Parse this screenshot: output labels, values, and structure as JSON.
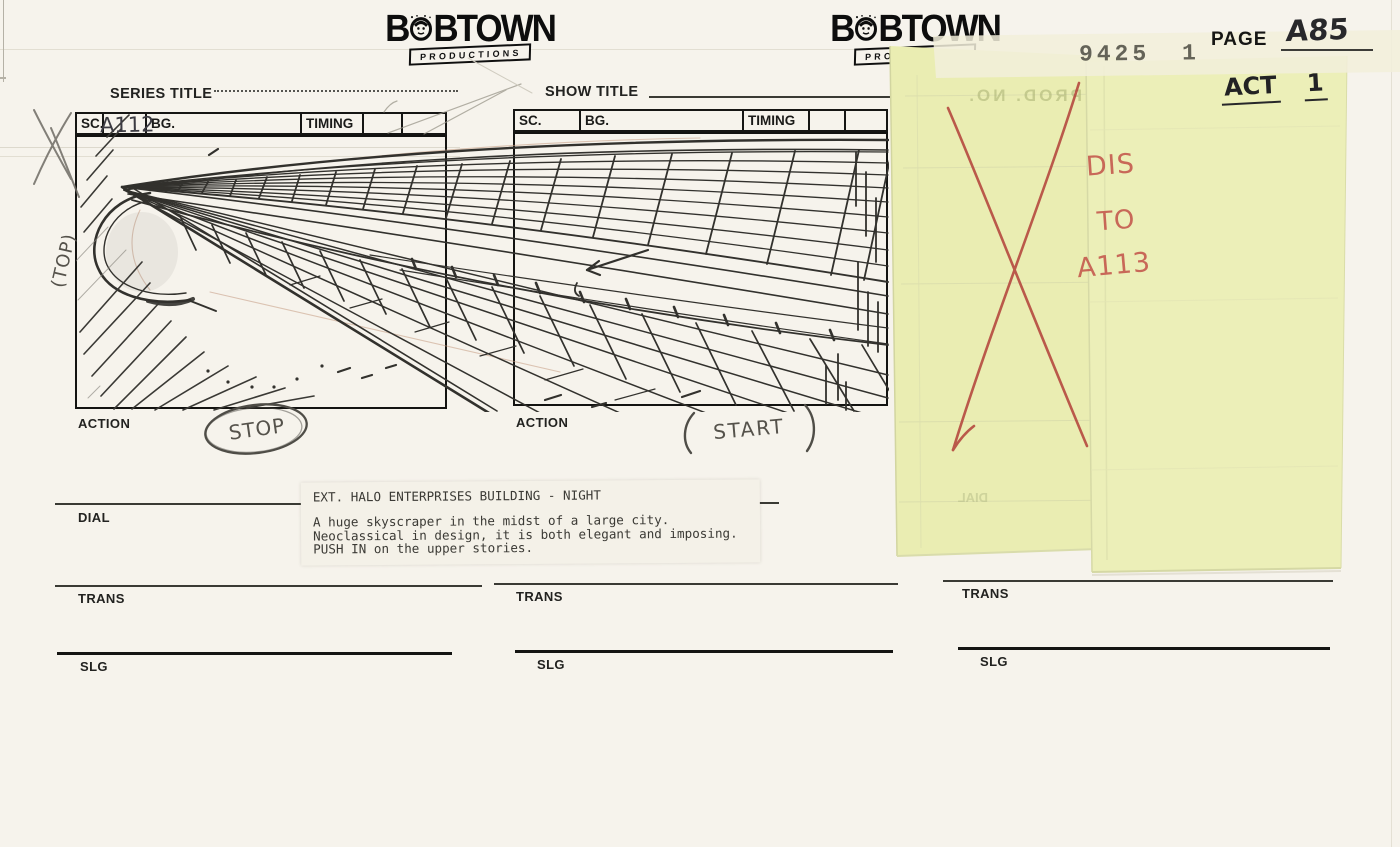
{
  "logo": {
    "word_start": "B",
    "word_end": "BTOWN",
    "banner": "PRODUCTIONS"
  },
  "header": {
    "stamp": "9425 1",
    "page_label": "PAGE",
    "page_number": "A85",
    "act_label": "ACT",
    "act_number": "1"
  },
  "form": {
    "series_title_label": "SERIES TITLE",
    "show_title_label": "SHOW TITLE",
    "sc_label": "SC.",
    "bg_label": "BG.",
    "timing_label": "TIMING",
    "action_label": "ACTION",
    "dial_label": "DIAL",
    "trans_label": "TRANS",
    "slg_label": "SLG",
    "panel1_scene_number": "A112"
  },
  "annotations": {
    "top_note": "(TOP)",
    "stop_note": "STOP",
    "start_note": "START",
    "dissolve_line1": "DIS",
    "dissolve_line2": "TO",
    "dissolve_line3": "A113"
  },
  "script_note": {
    "slugline": "EXT.  HALO ENTERPRISES BUILDING - NIGHT",
    "line1": "A huge skyscraper in the midst of a large city.",
    "line2": "Neoclassical in design, it is both elegant and imposing.",
    "line3": "PUSH IN on the upper stories."
  },
  "ghost_text": {
    "prod_no": "PROD. NO.",
    "dial": "DIAL"
  },
  "colors": {
    "paper": "#f6f3ec",
    "ink": "#141412",
    "note_yellow": "#eaedb2",
    "red_marker": "#b5493f",
    "pencil": "#55524b"
  }
}
